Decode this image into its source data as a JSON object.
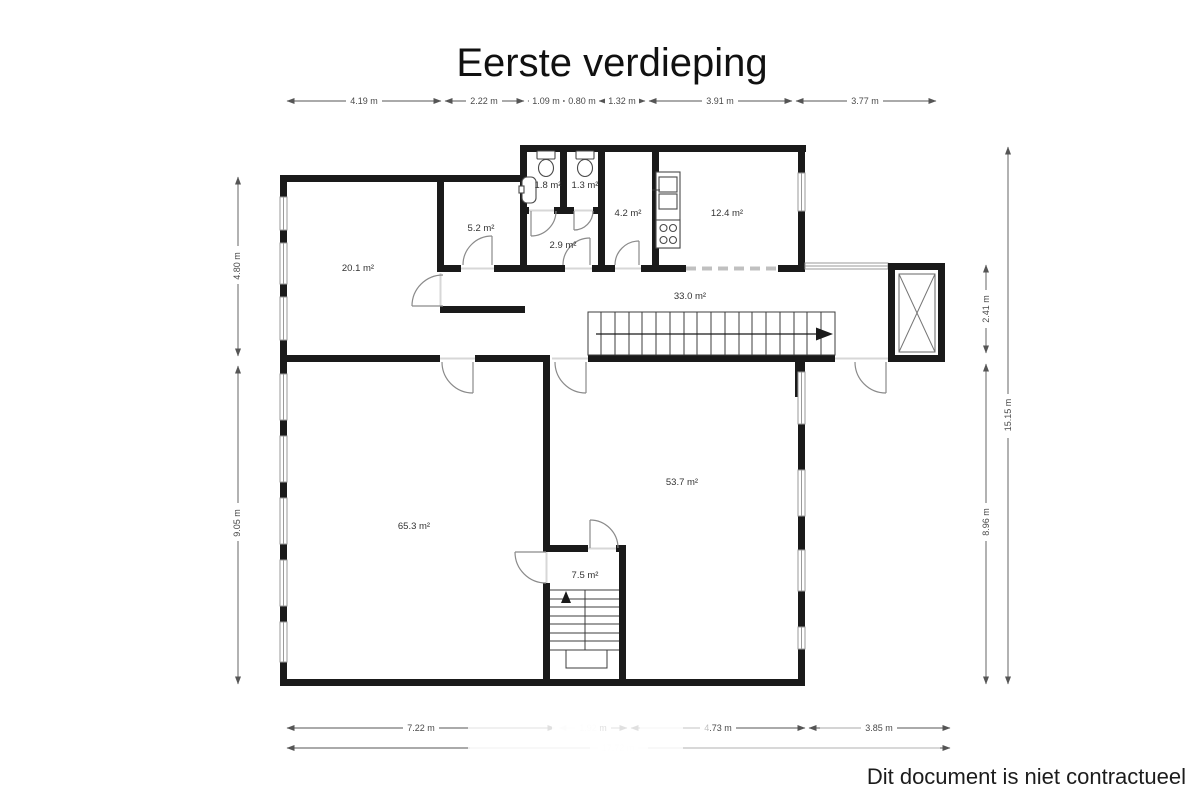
{
  "title": "Eerste verdieping",
  "disclaimer": "Dit document is niet contractueel",
  "rooms": {
    "living": "20.1 m²",
    "cabinet": "5.2 m²",
    "wc_left": "1.8 m²",
    "wc_right": "1.3 m²",
    "washroom": "2.9 m²",
    "storage": "4.2 m²",
    "kitchen": "12.4 m²",
    "hallway": "33.0 m²",
    "hall_left": "65.3 m²",
    "hall_right": "53.7 m²",
    "stair_lobby": "7.5 m²"
  },
  "dimensions": {
    "top": [
      "4.19 m",
      "2.22 m",
      "1.09 m",
      "0.80 m",
      "1.32 m",
      "3.91 m",
      "3.77 m"
    ],
    "bottom": [
      "7.22 m",
      "1.92 m",
      "4.73 m",
      "3.85 m"
    ],
    "bottom_total": "17.72 m",
    "left_upper": "4.80 m",
    "left_lower": "9.05 m",
    "right_upper": "2.41 m",
    "right_lower": "8.96 m",
    "right_total": "15.15 m"
  },
  "colors": {
    "wall": "#1a1a1a",
    "annotation": "#4a4a4a",
    "door_arc": "#8a8a8a",
    "background": "#ffffff"
  }
}
